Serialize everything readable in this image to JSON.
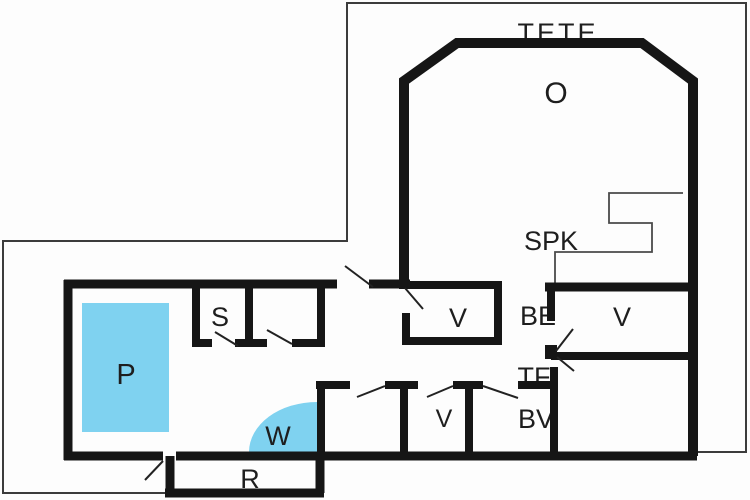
{
  "floorplan": {
    "labels": {
      "tete": "TETE",
      "o": "O",
      "spk": "SPK",
      "be": "BE",
      "v_right": "V",
      "tf": "TF",
      "bv": "BV",
      "v_middle": "V",
      "v_bottom": "V",
      "s": "S",
      "p": "P",
      "w": "W",
      "r": "R"
    },
    "colors": {
      "water": "#7FD2F0",
      "wall": "#161616",
      "boundary": "#3C3C3C",
      "thin_line": "#4A4A4A",
      "door_line": "#222222",
      "label": "#1E1E1E",
      "background": "#FDFDFD"
    }
  }
}
